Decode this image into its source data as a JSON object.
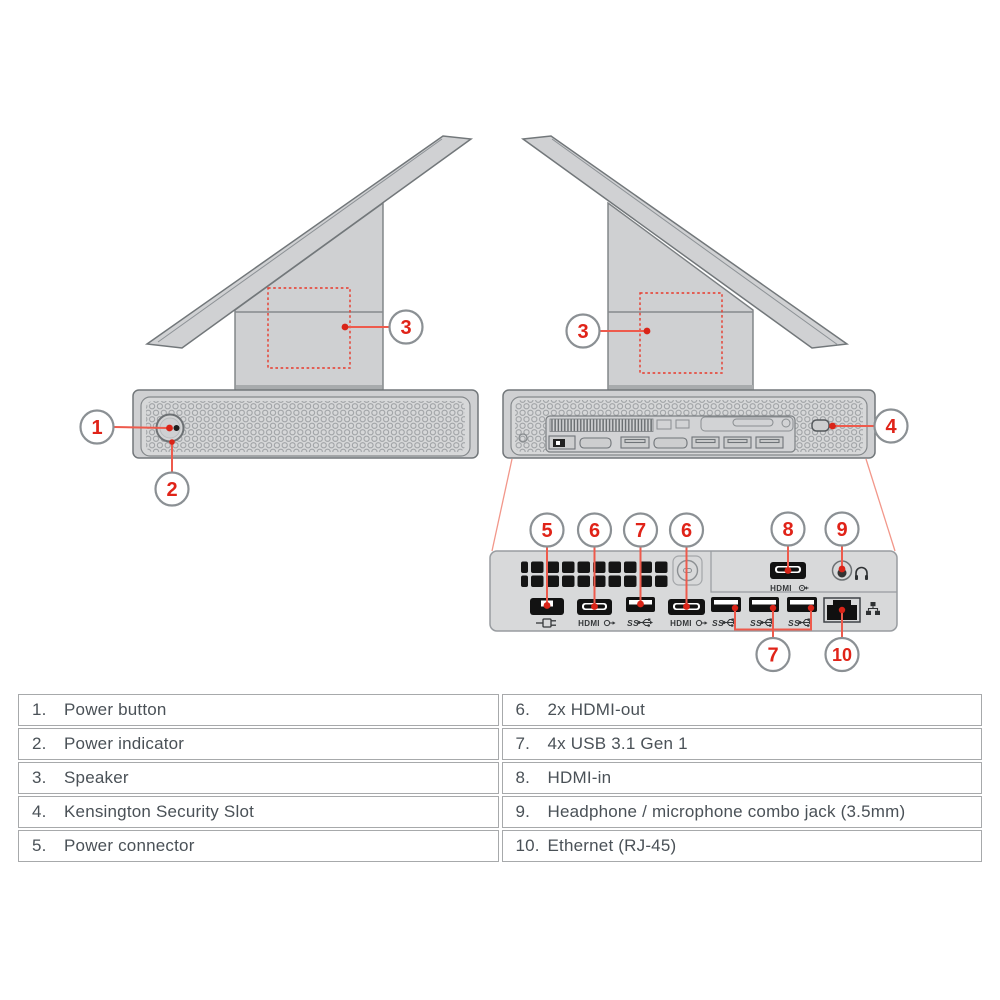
{
  "colors": {
    "accent_red": "#e02318",
    "leader_red": "#ee5a4c",
    "device_gray": "#d2d3d4",
    "outline_gray": "#7c8083",
    "callout_ring": "#8b9094",
    "table_border": "#a7a9ab",
    "table_text": "#4a5157"
  },
  "diagram": {
    "callout_numbers": {
      "n1": "1",
      "n2": "2",
      "n3": "3",
      "n4": "4",
      "n5": "5",
      "n6": "6",
      "n7": "7",
      "n8": "8",
      "n9": "9",
      "n10": "10"
    },
    "port_labels": {
      "hdmi": "HDMI",
      "usb_ss": "SS"
    }
  },
  "legend": {
    "left": [
      {
        "num": "1.",
        "label": "Power button"
      },
      {
        "num": "2.",
        "label": "Power indicator"
      },
      {
        "num": "3.",
        "label": "Speaker"
      },
      {
        "num": "4.",
        "label": "Kensington Security Slot"
      },
      {
        "num": "5.",
        "label": "Power connector"
      }
    ],
    "right": [
      {
        "num": "6.",
        "label": "2x HDMI-out"
      },
      {
        "num": "7.",
        "label": "4x USB 3.1 Gen 1"
      },
      {
        "num": "8.",
        "label": "HDMI-in"
      },
      {
        "num": "9.",
        "label": "Headphone / microphone combo jack (3.5mm)"
      },
      {
        "num": "10.",
        "label": "Ethernet (RJ-45)"
      }
    ]
  }
}
